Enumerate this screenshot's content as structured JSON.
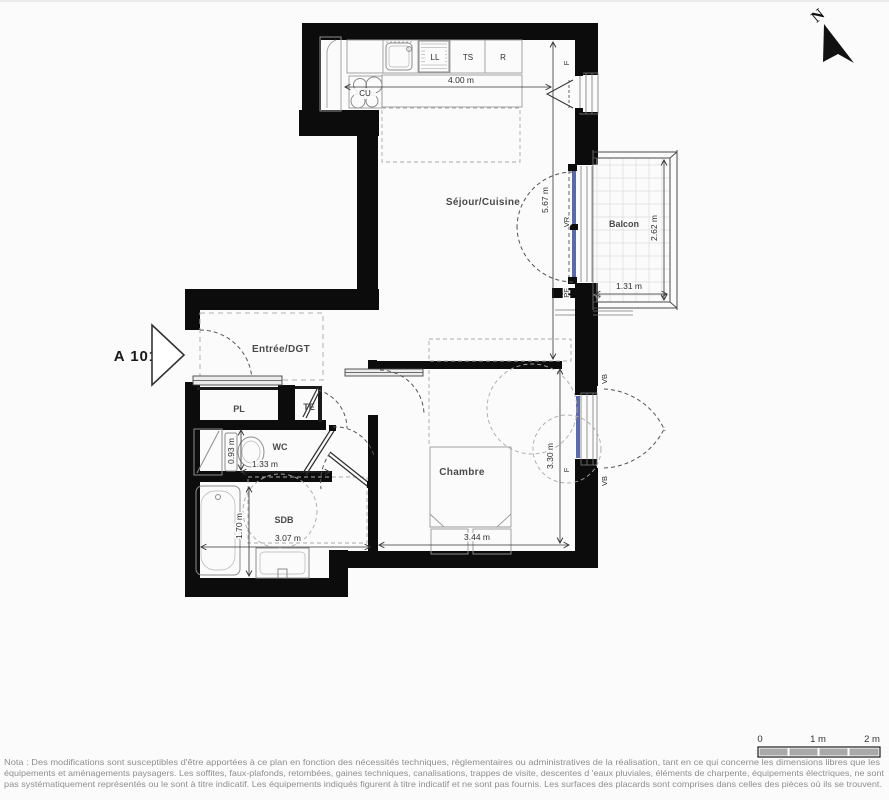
{
  "unit": {
    "label": "A 101"
  },
  "compass": {
    "north": "N"
  },
  "rooms": {
    "sejour": "Séjour/Cuisine",
    "balcon": "Balcon",
    "entree": "Entrée/DGT",
    "chambre": "Chambre",
    "wc": "WC",
    "sdb": "SDB",
    "pl": "PL",
    "te": "TE"
  },
  "appliances": {
    "cu": "CU",
    "ll": "LL",
    "ts": "TS",
    "r": "R"
  },
  "openings": {
    "kitchen_window": "F",
    "balcony_shutter": "VR",
    "balcony_door": "PF",
    "bedroom_window": "F",
    "bedroom_shutter_top": "VB",
    "bedroom_shutter_bottom": "VB"
  },
  "dimensions": {
    "kitchen_width": "4.00 m",
    "sejour_depth": "5.67 m",
    "balcon_depth": "2.62 m",
    "balcon_width": "1.31 m",
    "wc_depth": "0.93 m",
    "wc_width": "1.33 m",
    "sdb_depth": "1.70 m",
    "sdb_width": "3.07 m",
    "chambre_width": "3.44 m",
    "chambre_depth": "3.30 m"
  },
  "scalebar": {
    "tick0": "0",
    "tick1": "1 m",
    "tick2": "2 m"
  },
  "nota": {
    "line1": "Nota : Des modifications sont susceptibles d'être apportées à ce plan en fonction des nécessités techniques, règlementaires ou administratives de la réalisation, tant en ce qui concerne les dimensions libres que les",
    "line2": "équipements et aménagements paysagers. Les soffites, faux-plafonds, retombées, gaines techniques, canalisations, trappes de visite, descentes d 'eaux pluviales, éléments de charpente, équipements électriques, ne sont",
    "line3": "pas systématiquement représentés ou le sont à titre indicatif. Les équipements indiqués figurent à titre indicatif et ne sont pas fournis. Les surfaces des placards sont comprises dans celles des pièces où ils se trouvent."
  },
  "colors": {
    "wall": "#0c0c0c",
    "glazing": "#5b6aa9",
    "fixture_line": "#8c8c8c",
    "dash_line": "#999999",
    "room_label": "#4a4a4a",
    "dim_label": "#2f2f2f",
    "nota_text": "#8f8f8f",
    "background": "#fbfbfb"
  }
}
